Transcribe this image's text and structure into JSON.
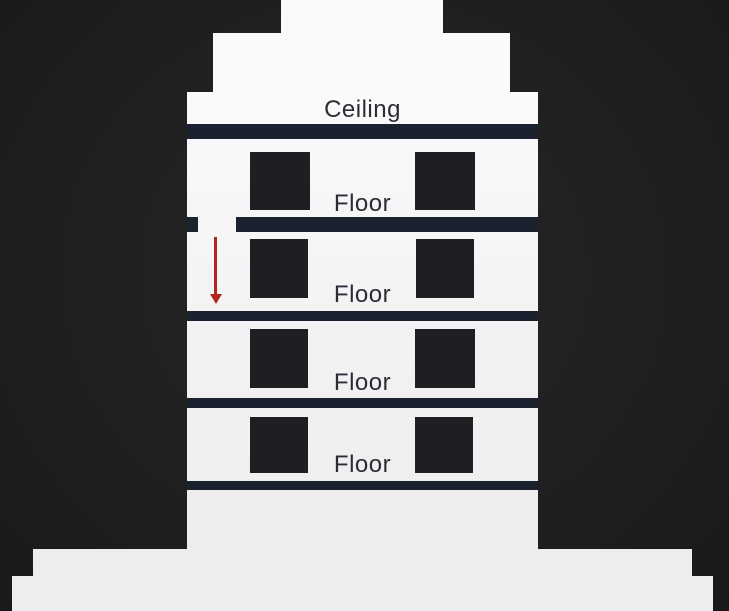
{
  "diagram": {
    "title_label": "Ceiling",
    "floor_labels": [
      "Floor",
      "Floor",
      "Floor",
      "Floor"
    ],
    "arrow": {
      "name": "falling-down-arrow",
      "direction": "down",
      "color": "#b2261f"
    },
    "colors": {
      "bg": "#1d1d1d",
      "bg-light": "#272727",
      "building": "#f2f2f3",
      "building-top": "#fafafb",
      "building-bottom": "#ededee",
      "slab": "#1b212e",
      "window": "#1e1f23",
      "text": "#2a2d35",
      "arrow": "#b2261f"
    }
  }
}
